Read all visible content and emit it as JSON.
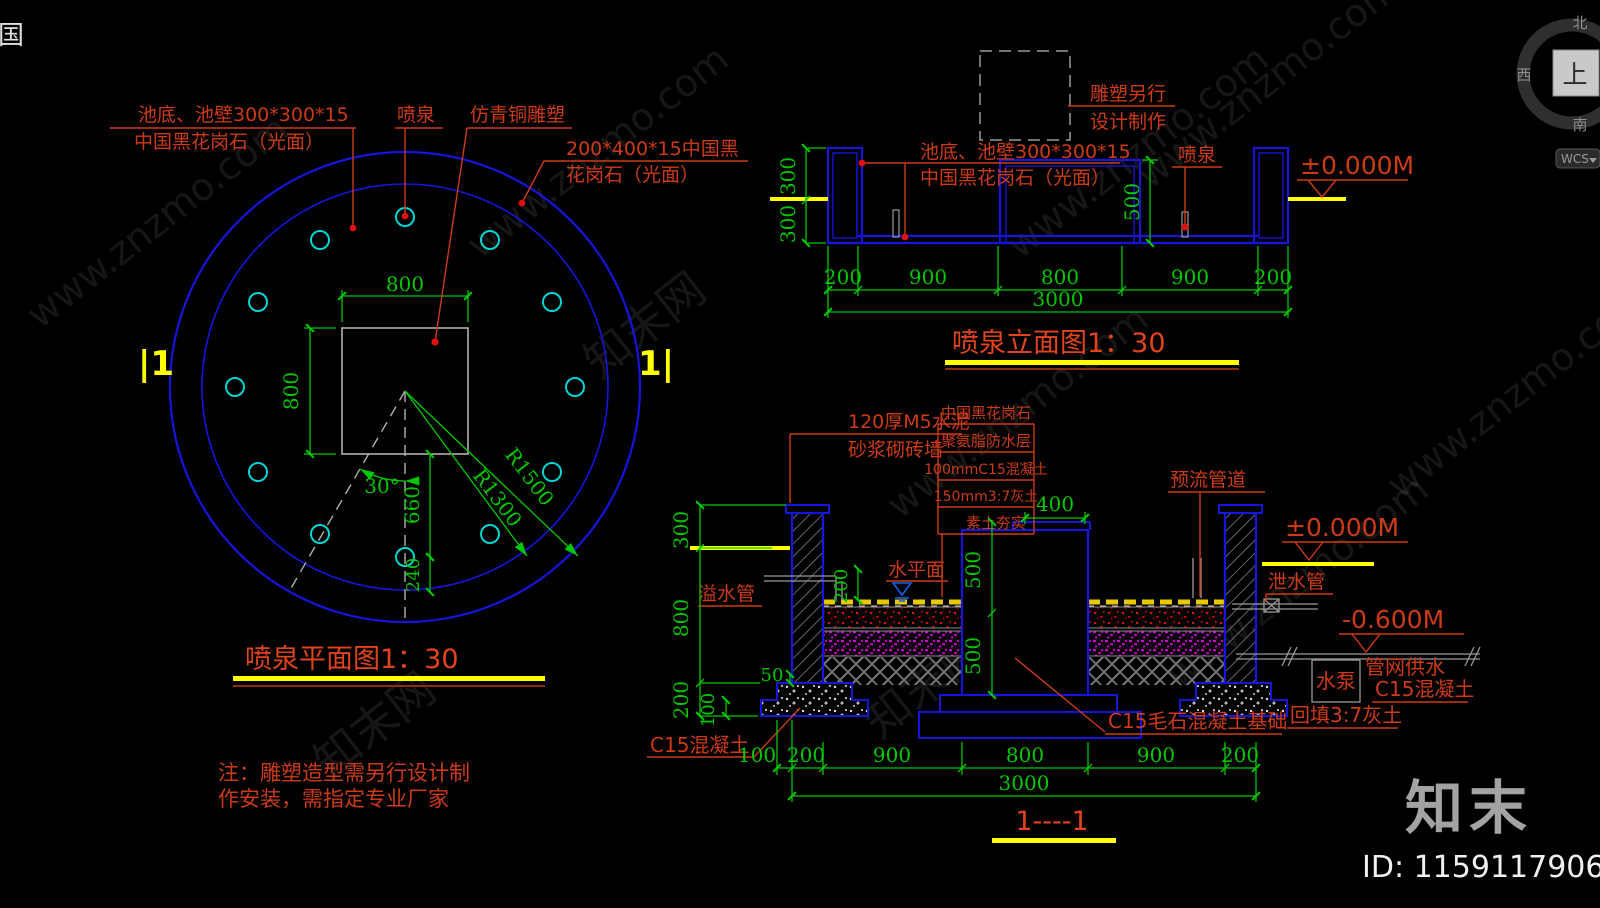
{
  "colors": {
    "red": "#cd3a16",
    "title_red": "#e2431a",
    "green": "#00c800",
    "blue": "#1515dd",
    "cyan": "#00d4d4",
    "yellow": "#ffff00",
    "gray": "#9a9a9a"
  },
  "watermark": {
    "site": "www.znzmo.com",
    "brand": "知末网"
  },
  "corner_icon": "国",
  "viewcube": {
    "north": "北",
    "west": "西",
    "south": "南",
    "top": "上",
    "wcs": "WCS"
  },
  "branding": {
    "logo": "知末",
    "id": "ID: 1159117906"
  },
  "plan": {
    "title": "喷泉平面图1：30",
    "note1": "注：雕塑造型需另行设计制",
    "note2": "作安装，需指定专业厂家",
    "marker_left": "|1",
    "marker_right": "1|",
    "labels": {
      "pool_tile1": "池底、池壁300*300*15",
      "pool_tile2": "中国黑花岗石（光面）",
      "fountain": "喷泉",
      "sculpture": "仿青铜雕塑",
      "coping1": "200*400*15中国黑",
      "coping2": "花岗石（光面）"
    },
    "dims": {
      "top": "800",
      "left": "800",
      "angle": "30°",
      "d660": "660",
      "d240": "240",
      "r1500": "R1500",
      "r1300": "R1300"
    }
  },
  "elevation": {
    "title": "喷泉立面图1：30",
    "labels": {
      "sculpture1": "雕塑另行",
      "sculpture2": "设计制作",
      "pool_tile1": "池底、池壁300*300*15",
      "pool_tile2": "中国黑花岗石（光面）",
      "fountain": "喷泉",
      "level": "±0.000M"
    },
    "dims": {
      "left_top": "300",
      "left_bottom": "300",
      "pedestal": "500",
      "row": [
        "200",
        "900",
        "800",
        "900",
        "200"
      ],
      "total": "3000"
    }
  },
  "section": {
    "title": "1----1",
    "labels": {
      "brick1": "120厚M5水泥",
      "brick2": "砂浆砌砖墙",
      "stack": [
        "中国黑花岗石",
        "聚氨脂防水层",
        "100mmC15混凝土",
        "150mm3:7灰土",
        "素土夯实"
      ],
      "preflow": "预流管道",
      "level0": "±0.000M",
      "drain": "泄水管",
      "level600": "-0.600M",
      "pump": "水泵",
      "supply1": "管网供水",
      "supply2": "C15混凝土",
      "backfill": "回填3:7灰土",
      "overflow": "溢水管",
      "water_surface": "水平面",
      "footing": "C15混凝土",
      "foundation": "C15毛石混凝土基础"
    },
    "dims": {
      "cap400": "400",
      "p500a": "500",
      "p500b": "500",
      "left300": "300",
      "left800": "800",
      "left200": "200",
      "d50": "50",
      "d100": "100",
      "water200": "200",
      "row": [
        "100",
        "200",
        "900",
        "800",
        "900",
        "200"
      ],
      "total": "3000"
    }
  }
}
